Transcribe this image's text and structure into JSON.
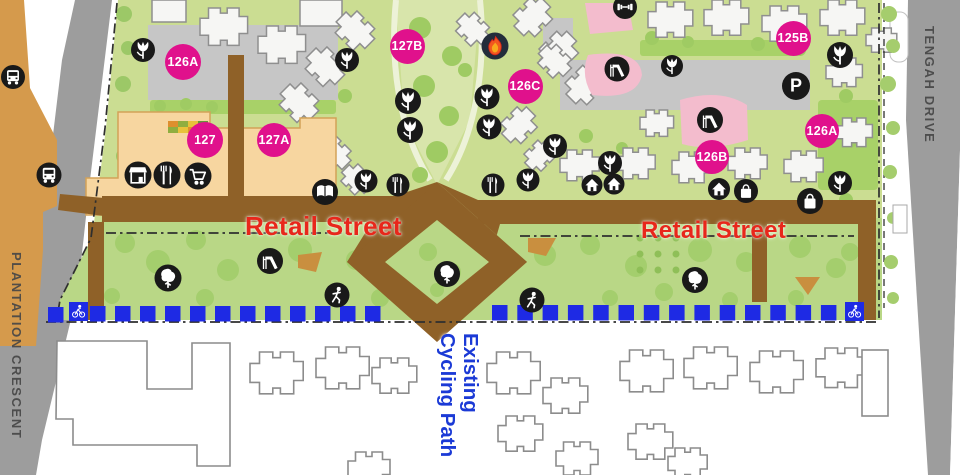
{
  "map": {
    "street_labels": {
      "retail_left": "Retail Street",
      "retail_right": "Retail Street"
    },
    "path_label": {
      "full": "Existing Cycling Path",
      "line1": "Existing",
      "line2": "Cycling Path"
    },
    "road_labels": {
      "west": "PLANTATION CRESCENT",
      "east": "TENGAH DRIVE"
    },
    "badges": [
      {
        "label": "126A",
        "x": 183,
        "y": 62,
        "d": 36
      },
      {
        "label": "127",
        "x": 205,
        "y": 140,
        "d": 36
      },
      {
        "label": "127A",
        "x": 274,
        "y": 140,
        "d": 34
      },
      {
        "label": "127B",
        "x": 407,
        "y": 46,
        "d": 35
      },
      {
        "label": "126C",
        "x": 525,
        "y": 86,
        "d": 35
      },
      {
        "label": "125B",
        "x": 793,
        "y": 38,
        "d": 35
      },
      {
        "label": "126B",
        "x": 712,
        "y": 157,
        "d": 34
      },
      {
        "label": "126A",
        "x": 822,
        "y": 131,
        "d": 34
      }
    ],
    "icons": [
      {
        "type": "bus",
        "x": 13,
        "y": 77,
        "r": 12
      },
      {
        "type": "bus",
        "x": 49,
        "y": 175,
        "r": 12.5
      },
      {
        "type": "flower",
        "x": 143,
        "y": 50,
        "r": 12
      },
      {
        "type": "store",
        "x": 138,
        "y": 175,
        "r": 13.5
      },
      {
        "type": "cutlery",
        "x": 167,
        "y": 175,
        "r": 13.5
      },
      {
        "type": "cart",
        "x": 198,
        "y": 176,
        "r": 13.5
      },
      {
        "type": "flower",
        "x": 347,
        "y": 60,
        "r": 12
      },
      {
        "type": "flower",
        "x": 408,
        "y": 101,
        "r": 13
      },
      {
        "type": "flower",
        "x": 410,
        "y": 130,
        "r": 13
      },
      {
        "type": "flower",
        "x": 487,
        "y": 97,
        "r": 12.5
      },
      {
        "type": "flower",
        "x": 489,
        "y": 127,
        "r": 12.5
      },
      {
        "type": "flame",
        "x": 495,
        "y": 46,
        "r": 13.5,
        "bg": "#232d3b"
      },
      {
        "type": "gym",
        "x": 625,
        "y": 7,
        "r": 12
      },
      {
        "type": "slide",
        "x": 617,
        "y": 69,
        "r": 12.5
      },
      {
        "type": "flower",
        "x": 555,
        "y": 146,
        "r": 12
      },
      {
        "type": "flower",
        "x": 610,
        "y": 163,
        "r": 12
      },
      {
        "type": "book",
        "x": 325,
        "y": 192,
        "r": 13
      },
      {
        "type": "flower",
        "x": 366,
        "y": 181,
        "r": 11.5
      },
      {
        "type": "cutlery",
        "x": 398,
        "y": 185,
        "r": 11.5
      },
      {
        "type": "cutlery",
        "x": 493,
        "y": 185,
        "r": 11.5
      },
      {
        "type": "flower",
        "x": 528,
        "y": 180,
        "r": 11.5
      },
      {
        "type": "house",
        "x": 592,
        "y": 185,
        "r": 10.5
      },
      {
        "type": "house",
        "x": 614,
        "y": 184,
        "r": 10.5
      },
      {
        "type": "parking",
        "glyph": "P",
        "x": 796,
        "y": 86,
        "r": 14
      },
      {
        "type": "flower",
        "x": 672,
        "y": 66,
        "r": 11
      },
      {
        "type": "flower",
        "x": 840,
        "y": 55,
        "r": 13
      },
      {
        "type": "slide",
        "x": 710,
        "y": 120,
        "r": 13
      },
      {
        "type": "flower",
        "x": 840,
        "y": 183,
        "r": 12
      },
      {
        "type": "house",
        "x": 719,
        "y": 189,
        "r": 11
      },
      {
        "type": "bag",
        "x": 746,
        "y": 191,
        "r": 12
      },
      {
        "type": "bag",
        "x": 810,
        "y": 201,
        "r": 13
      },
      {
        "type": "tree",
        "x": 168,
        "y": 278,
        "r": 13.5
      },
      {
        "type": "slide",
        "x": 270,
        "y": 261,
        "r": 13
      },
      {
        "type": "runner",
        "x": 337,
        "y": 295,
        "r": 12.5
      },
      {
        "type": "tree",
        "x": 447,
        "y": 274,
        "r": 13
      },
      {
        "type": "runner",
        "x": 532,
        "y": 300,
        "r": 12.5
      },
      {
        "type": "tree",
        "x": 695,
        "y": 280,
        "r": 13
      }
    ],
    "cycling_path": {
      "segments": [
        {
          "x": 48,
          "y": 307,
          "count": 1,
          "step": 25,
          "size": 15.5
        },
        {
          "x": 90,
          "y": 306,
          "count": 12,
          "step": 25,
          "size": 15.5
        },
        {
          "x": 492,
          "y": 305,
          "count": 14,
          "step": 25.3,
          "size": 15.5
        }
      ],
      "markers": [
        {
          "x": 69,
          "y": 302,
          "size": 19
        },
        {
          "x": 845,
          "y": 302,
          "size": 19
        }
      ]
    },
    "colors": {
      "badge": "#e0118c",
      "cycling_blue": "#1e2ae4",
      "retail_text": "#e8271b",
      "path_text": "#1b3ad6",
      "road_text": "#474747",
      "retail_street_brown": "#8f6128",
      "site_green": "#cbdd92",
      "lawn_green": "#b9d786",
      "road_gray": "#9d9d9d",
      "commercial_orange": "#f7d6a0",
      "playground_pink": "#f3bccd"
    }
  }
}
